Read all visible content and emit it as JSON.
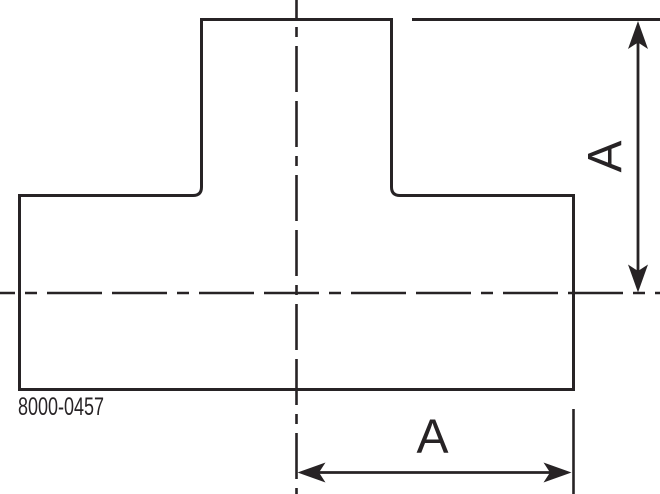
{
  "colors": {
    "line": "#272325",
    "background": "#ffffff"
  },
  "drawing": {
    "part_number": "8000-0457",
    "dimensions": {
      "vertical": {
        "label": "A"
      },
      "horizontal": {
        "label": "A"
      }
    },
    "icons": {
      "arrow_up": "filled dimension arrowhead pointing up",
      "arrow_down": "filled dimension arrowhead pointing down",
      "arrow_left": "filled dimension arrowhead pointing left",
      "arrow_right": "filled dimension arrowhead pointing right"
    }
  }
}
